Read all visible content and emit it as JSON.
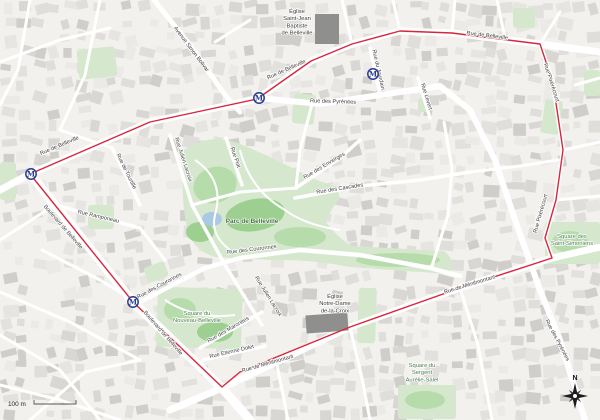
{
  "map": {
    "colors": {
      "boundary_red": "#d7263d",
      "metro_blue": "#2a3b8f",
      "park_green": "#d5e8cd",
      "park_green_mid": "#b7dcab",
      "park_green_dark": "#9ccf90",
      "water_blue": "#aac9e5",
      "background": "#f2f1ee",
      "street_white": "#ffffff",
      "church_gray": "#8f8f8d"
    },
    "street_labels": [
      {
        "text": "Rue de Belleville",
        "x": 60,
        "y": 147,
        "rot": -23
      },
      {
        "text": "Rue de Belleville",
        "x": 287,
        "y": 71,
        "rot": -24
      },
      {
        "text": "Rue de Belleville",
        "x": 487,
        "y": 37,
        "rot": 7
      },
      {
        "text": "Rue des Pyrénées",
        "x": 333,
        "y": 103,
        "rot": 2
      },
      {
        "text": "Rue des Pyrénées",
        "x": 556,
        "y": 341,
        "rot": 62
      },
      {
        "text": "Avenue Simon Bolivar",
        "x": 190,
        "y": 50,
        "rot": 53
      },
      {
        "text": "Boulevard de Belleville",
        "x": 62,
        "y": 228,
        "rot": 49
      },
      {
        "text": "Boulevard de Belleville",
        "x": 162,
        "y": 334,
        "rot": 49
      },
      {
        "text": "Rue de Ménilmontant",
        "x": 268,
        "y": 365,
        "rot": -16
      },
      {
        "text": "Rue de Ménilmontant",
        "x": 470,
        "y": 286,
        "rot": -17
      },
      {
        "text": "Rue Pixérécourt",
        "x": 550,
        "y": 83,
        "rot": 72
      },
      {
        "text": "Rue Pixérécourt",
        "x": 542,
        "y": 214,
        "rot": -74
      },
      {
        "text": "Rue du Jourdain",
        "x": 377,
        "y": 70,
        "rot": 77
      },
      {
        "text": "Rue de Tourtille",
        "x": 125,
        "y": 172,
        "rot": 64
      },
      {
        "text": "Rue Julien Lacroix",
        "x": 182,
        "y": 160,
        "rot": 72
      },
      {
        "text": "Rue Julien Lacroix",
        "x": 267,
        "y": 297,
        "rot": 58
      },
      {
        "text": "Rue Ramponeau",
        "x": 98,
        "y": 218,
        "rot": 13
      },
      {
        "text": "Rue Piat",
        "x": 234,
        "y": 158,
        "rot": 71
      },
      {
        "text": "Rue des Envierges",
        "x": 325,
        "y": 167,
        "rot": -31
      },
      {
        "text": "Rue des Cascades",
        "x": 340,
        "y": 190,
        "rot": -9
      },
      {
        "text": "Rue des Couronnes",
        "x": 252,
        "y": 251,
        "rot": -7
      },
      {
        "text": "Rue des Couronnes",
        "x": 160,
        "y": 287,
        "rot": -28
      },
      {
        "text": "Rue des Maronites",
        "x": 229,
        "y": 331,
        "rot": -30
      },
      {
        "text": "Rue Etienne Dolet",
        "x": 232,
        "y": 353,
        "rot": -13
      },
      {
        "text": "Rue Levert",
        "x": 425,
        "y": 97,
        "rot": 73
      }
    ],
    "poi_labels": [
      {
        "lines": [
          "Église",
          "Saint-Jean",
          "Baptiste",
          "de Belleville"
        ],
        "x": 297,
        "y": 13,
        "cls": "poi-dark"
      },
      {
        "lines": [
          "Église",
          "Notre-Dame",
          "de-la-Croix"
        ],
        "x": 335,
        "y": 298,
        "cls": "poi-dark"
      },
      {
        "lines": [
          "Square des",
          "Saint-Simoniens"
        ],
        "x": 572,
        "y": 238,
        "cls": "poi-green"
      },
      {
        "lines": [
          "Square du",
          "Nouveau-Belleville"
        ],
        "x": 197,
        "y": 315,
        "cls": "poi-green"
      },
      {
        "lines": [
          "Square du",
          "Sergent",
          "Aurélie-Salel"
        ],
        "x": 422,
        "y": 367,
        "cls": "poi-green"
      },
      {
        "lines": [
          "Parc de Belleville"
        ],
        "x": 252,
        "y": 223,
        "cls": "park-name"
      }
    ],
    "metro_stations": [
      {
        "x": 31,
        "y": 174
      },
      {
        "x": 259,
        "y": 98
      },
      {
        "x": 373,
        "y": 74
      },
      {
        "x": 133,
        "y": 302
      }
    ],
    "metro_letter": "M",
    "scale": {
      "label": "100 m"
    },
    "compass": {
      "label": "N"
    }
  }
}
